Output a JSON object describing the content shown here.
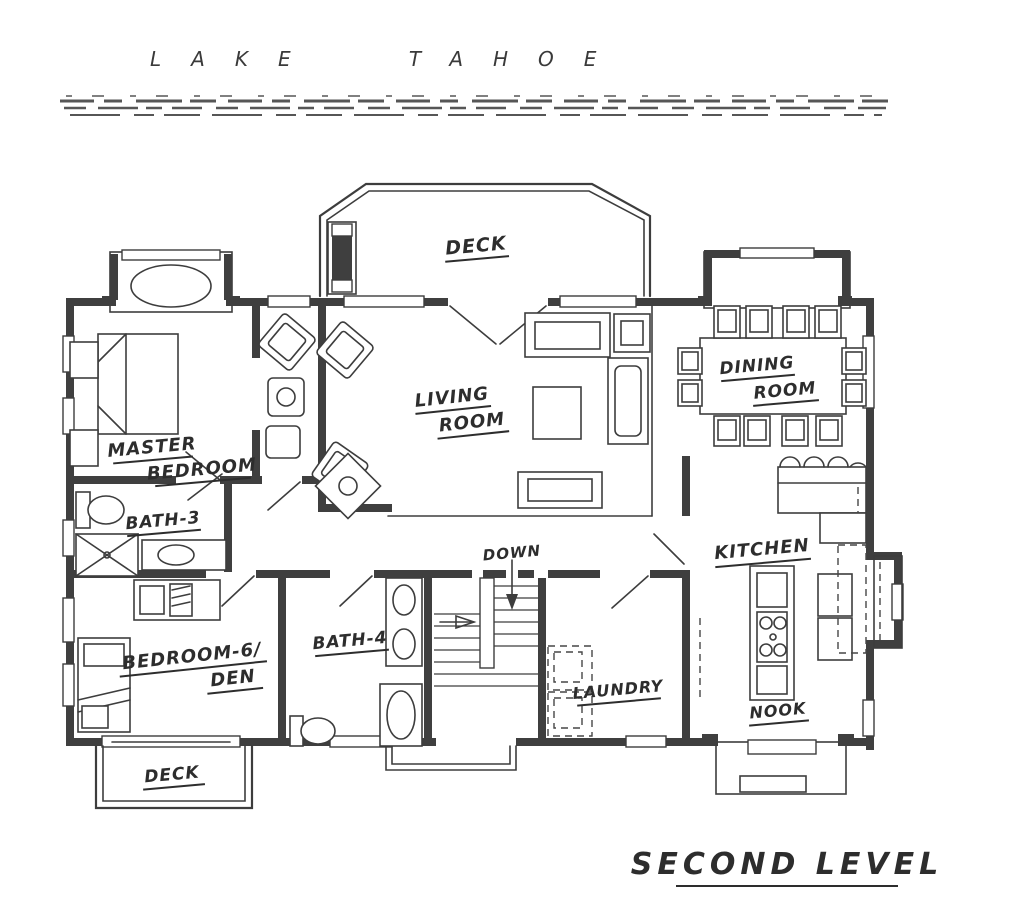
{
  "site": {
    "water_label": "LAKE TAHOE"
  },
  "title": "SECOND LEVEL",
  "rooms": {
    "deck_top": "DECK",
    "living_line1": "LIVING",
    "living_line2": "ROOM",
    "dining_line1": "DINING",
    "dining_line2": "ROOM",
    "master_line1": "MASTER",
    "master_line2": "BEDROOM",
    "bath3": "BATH-3",
    "bedroom6_line1": "BEDROOM-6/",
    "bedroom6_line2": "DEN",
    "bath4": "BATH-4",
    "stairs_down": "DOWN",
    "laundry": "LAUNDRY",
    "kitchen": "KITCHEN",
    "nook": "NOOK",
    "deck_bottom": "DECK"
  },
  "colors": {
    "ink": "#3d3d3d",
    "wall_fill": "#3f3f3f",
    "paper": "#ffffff",
    "shoreline": "#565656"
  }
}
